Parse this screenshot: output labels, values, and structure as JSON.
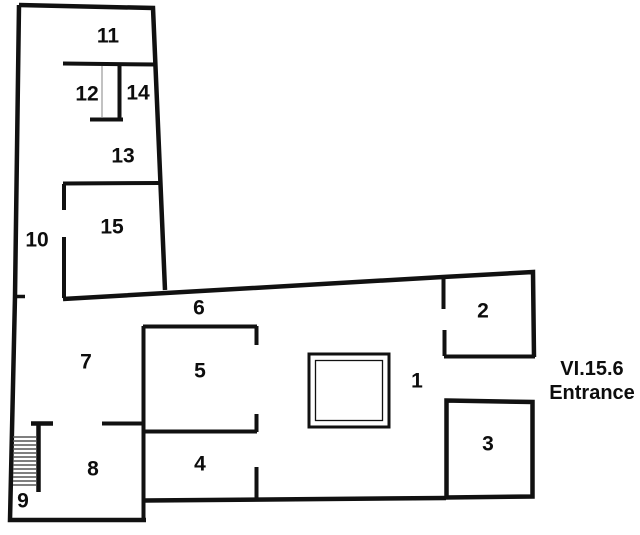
{
  "plan": {
    "rooms": [
      {
        "label": "1"
      },
      {
        "label": "2"
      },
      {
        "label": "3"
      },
      {
        "label": "4"
      },
      {
        "label": "5"
      },
      {
        "label": "6"
      },
      {
        "label": "7"
      },
      {
        "label": "8"
      },
      {
        "label": "9"
      },
      {
        "label": "10"
      },
      {
        "label": "11"
      },
      {
        "label": "12"
      },
      {
        "label": "13"
      },
      {
        "label": "14"
      },
      {
        "label": "15"
      }
    ],
    "entrance": {
      "line1": "VI.15.6",
      "line2": "Entrance"
    },
    "colors": {
      "wall": "#111111",
      "thin_line": "#9a9a9a",
      "stair_tread": "#555555",
      "background": "#ffffff"
    }
  }
}
